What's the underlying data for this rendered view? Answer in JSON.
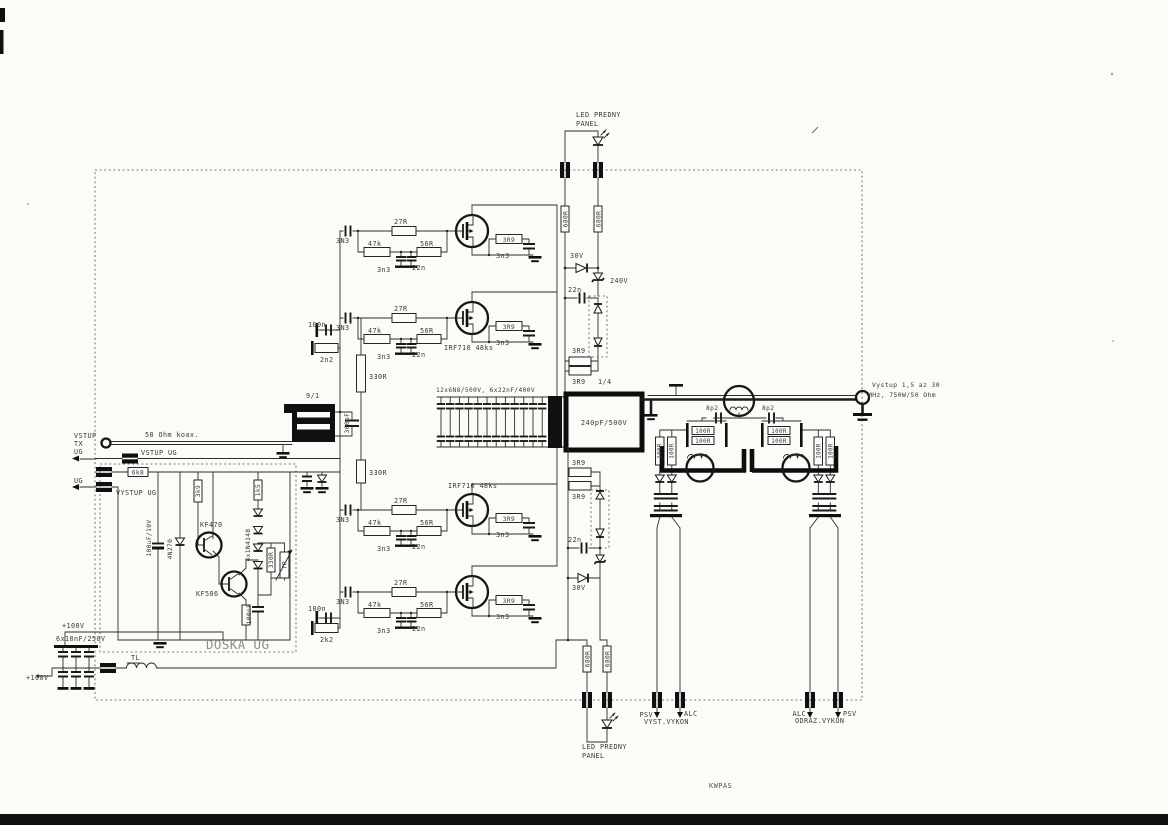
{
  "colors": {
    "ink": "#3a3a3a",
    "light": "#8e8e8e",
    "mid": "#555555",
    "bg": "#fbfbf8",
    "black": "#101010"
  },
  "labels": [
    {
      "n": "led-front-panel-top-1",
      "t": "LED PREDNY",
      "x": 576,
      "y": 117
    },
    {
      "n": "led-front-panel-top-2",
      "t": "PANEL",
      "x": 576,
      "y": 126
    },
    {
      "n": "res-680r-top-left",
      "t": "680R",
      "x": 567.3,
      "y": 219,
      "r": -90,
      "a": "m",
      "s": 6.2
    },
    {
      "n": "res-680r-top-right",
      "t": "680R",
      "x": 600.3,
      "y": 219,
      "r": -90,
      "a": "m",
      "s": 6.2
    },
    {
      "n": "diode-30v-top",
      "t": "30V",
      "x": 570,
      "y": 258
    },
    {
      "n": "zener-240v-top",
      "t": "240V",
      "x": 610,
      "y": 283
    },
    {
      "n": "cap-22n-top",
      "t": "22n",
      "x": 568,
      "y": 292
    },
    {
      "n": "res-3r9-top-upper",
      "t": "3R9",
      "x": 572,
      "y": 353
    },
    {
      "n": "res-3r9-top-lower",
      "t": "3R9",
      "x": 572,
      "y": 384
    },
    {
      "n": "res-3r9-top-fraction",
      "t": "1/4",
      "x": 598,
      "y": 384
    },
    {
      "n": "cap-3n3-input-1",
      "t": "3N3",
      "x": 336,
      "y": 243
    },
    {
      "n": "res-27r-1",
      "t": "27R",
      "x": 394,
      "y": 224
    },
    {
      "n": "res-47k-1",
      "t": "47k",
      "x": 368,
      "y": 246
    },
    {
      "n": "res-56r-1",
      "t": "56R",
      "x": 420,
      "y": 246
    },
    {
      "n": "cap-3n3-gnd-1",
      "t": "3n3",
      "x": 377,
      "y": 272
    },
    {
      "n": "cap-22n-gnd-1",
      "t": "22n",
      "x": 412,
      "y": 270
    },
    {
      "n": "res-3r9-fb-1",
      "t": "3R9",
      "x": 509,
      "y": 242,
      "a": "m",
      "s": 6.2
    },
    {
      "n": "cap-3n3-fb-1",
      "t": "3n3",
      "x": 496,
      "y": 258
    },
    {
      "n": "cap-100n-input-upper",
      "t": "100n",
      "x": 308,
      "y": 327
    },
    {
      "n": "res-2n2-input-upper",
      "t": "2n2",
      "x": 320,
      "y": 362
    },
    {
      "n": "cap-3n3-input-2",
      "t": "3N3",
      "x": 336,
      "y": 330
    },
    {
      "n": "res-27r-2",
      "t": "27R",
      "x": 394,
      "y": 311
    },
    {
      "n": "res-47k-2",
      "t": "47k",
      "x": 368,
      "y": 333
    },
    {
      "n": "res-56r-2",
      "t": "56R",
      "x": 420,
      "y": 333
    },
    {
      "n": "cap-3n3-gnd-2",
      "t": "3n3",
      "x": 377,
      "y": 359
    },
    {
      "n": "cap-22n-gnd-2",
      "t": "22n",
      "x": 412,
      "y": 357
    },
    {
      "n": "res-3r9-fb-2",
      "t": "3R9",
      "x": 509,
      "y": 329,
      "a": "m",
      "s": 6.2
    },
    {
      "n": "cap-3n3-fb-2",
      "t": "3n3",
      "x": 496,
      "y": 345
    },
    {
      "n": "mosfet-type-upper",
      "t": "IRF710 48ks",
      "x": 444,
      "y": 350
    },
    {
      "n": "mosfet-type-lower",
      "t": "IRF710 48ks",
      "x": 448,
      "y": 488
    },
    {
      "n": "cap-3n3-input-3",
      "t": "3N3",
      "x": 336,
      "y": 522
    },
    {
      "n": "res-27r-3",
      "t": "27R",
      "x": 394,
      "y": 503
    },
    {
      "n": "res-47k-3",
      "t": "47k",
      "x": 368,
      "y": 525
    },
    {
      "n": "res-56r-3",
      "t": "56R",
      "x": 420,
      "y": 525
    },
    {
      "n": "cap-3n3-gnd-3",
      "t": "3n3",
      "x": 377,
      "y": 551
    },
    {
      "n": "cap-22n-gnd-3",
      "t": "22n",
      "x": 412,
      "y": 549
    },
    {
      "n": "res-3r9-fb-3",
      "t": "3R9",
      "x": 509,
      "y": 521,
      "a": "m",
      "s": 6.2
    },
    {
      "n": "cap-3n3-fb-3",
      "t": "3n3",
      "x": 496,
      "y": 537
    },
    {
      "n": "cap-100n-input-lower",
      "t": "100n",
      "x": 308,
      "y": 611
    },
    {
      "n": "res-2k2-input-lower",
      "t": "2k2",
      "x": 320,
      "y": 642
    },
    {
      "n": "cap-3n3-input-4",
      "t": "3N3",
      "x": 336,
      "y": 604
    },
    {
      "n": "res-27r-4",
      "t": "27R",
      "x": 394,
      "y": 585
    },
    {
      "n": "res-47k-4",
      "t": "47k",
      "x": 368,
      "y": 607
    },
    {
      "n": "res-56r-4",
      "t": "56R",
      "x": 420,
      "y": 607
    },
    {
      "n": "cap-3n3-gnd-4",
      "t": "3n3",
      "x": 377,
      "y": 633
    },
    {
      "n": "cap-22n-gnd-4",
      "t": "22n",
      "x": 412,
      "y": 631
    },
    {
      "n": "res-3r9-fb-4",
      "t": "3R9",
      "x": 509,
      "y": 603,
      "a": "m",
      "s": 6.2
    },
    {
      "n": "cap-3n3-fb-4",
      "t": "3n3",
      "x": 496,
      "y": 619
    },
    {
      "n": "res-330r-upper",
      "t": "330R",
      "x": 369,
      "y": 379
    },
    {
      "n": "transformer-ratio",
      "t": "9/1",
      "x": 306,
      "y": 398
    },
    {
      "n": "cap-360pf",
      "t": "360pF",
      "x": 349,
      "y": 423,
      "r": -90,
      "a": "m",
      "s": 6.2
    },
    {
      "n": "res-330r-lower",
      "t": "330R",
      "x": 369,
      "y": 475
    },
    {
      "n": "input-vstup",
      "t": "VSTUP",
      "x": 74,
      "y": 438
    },
    {
      "n": "input-tx",
      "t": "TX",
      "x": 74,
      "y": 446
    },
    {
      "n": "coax-type",
      "t": "50 Ohm koax.",
      "x": 145,
      "y": 437
    },
    {
      "n": "ug-in-label",
      "t": "UG",
      "x": 74,
      "y": 454
    },
    {
      "n": "vstup-ug",
      "t": "VSTUP UG",
      "x": 141,
      "y": 455
    },
    {
      "n": "res-6k8",
      "t": "6k8",
      "x": 138,
      "y": 474.5,
      "a": "m",
      "s": 6.2
    },
    {
      "n": "ug-out-label",
      "t": "UG",
      "x": 74,
      "y": 483
    },
    {
      "n": "vystup-ug",
      "t": "VYSTUP UG",
      "x": 116,
      "y": 495
    },
    {
      "n": "cap-100uf",
      "t": "100uF/10V",
      "x": 151,
      "y": 538,
      "r": -90,
      "a": "m",
      "s": 6.2
    },
    {
      "n": "diode-4n270",
      "t": "4N270",
      "x": 172,
      "y": 549,
      "r": -90,
      "a": "m",
      "s": 6.2
    },
    {
      "n": "res-3k9",
      "t": "3k9",
      "x": 200,
      "y": 491,
      "r": -90,
      "a": "m",
      "s": 6.2
    },
    {
      "n": "res-1k5",
      "t": "1k5",
      "x": 260,
      "y": 490,
      "r": -90,
      "a": "m",
      "s": 6.2
    },
    {
      "n": "transistor-kf470",
      "t": "KF470",
      "x": 200,
      "y": 527
    },
    {
      "n": "diodes-4x1n4148",
      "t": "4x1N4148",
      "x": 250,
      "y": 545,
      "r": -90,
      "a": "m",
      "s": 6.2
    },
    {
      "n": "transistor-kf506",
      "t": "KF506",
      "x": 196,
      "y": 596
    },
    {
      "n": "res-330r-doska",
      "t": "330R",
      "x": 273,
      "y": 560,
      "r": -90,
      "a": "m",
      "s": 6.2
    },
    {
      "n": "trimmer-tr",
      "t": "TR",
      "x": 286.5,
      "y": 565,
      "r": -90,
      "a": "m",
      "s": 6.2
    },
    {
      "n": "cap-100nf",
      "t": "100nF",
      "x": 251,
      "y": 614,
      "r": -90,
      "a": "m",
      "s": 6.2
    },
    {
      "n": "board-name",
      "t": "DOSKA UG",
      "x": 206,
      "y": 649,
      "s": 12.5,
      "ls": 2,
      "c": "light"
    },
    {
      "n": "supply-100v-upper",
      "t": "+100V",
      "x": 62,
      "y": 628
    },
    {
      "n": "cap-bank-supply",
      "t": "6x10nF/250V",
      "x": 56,
      "y": 641
    },
    {
      "n": "supply-100v-lower",
      "t": "+100V",
      "x": 26,
      "y": 680
    },
    {
      "n": "inductor-tl",
      "t": "TL",
      "x": 131,
      "y": 660
    },
    {
      "n": "cap-bank-output",
      "t": "12x6N8/500V, 6x22nF/400V",
      "x": 436,
      "y": 392,
      "s": 6.2
    },
    {
      "n": "cap-240pf",
      "t": "240pF/500V",
      "x": 604,
      "y": 425,
      "a": "m",
      "s": 7
    },
    {
      "n": "res-3r9-bot-upper",
      "t": "3R9",
      "x": 572,
      "y": 465
    },
    {
      "n": "res-3r9-bot-lower",
      "t": "3R9",
      "x": 572,
      "y": 499
    },
    {
      "n": "cap-22n-bot",
      "t": "22n",
      "x": 568,
      "y": 542
    },
    {
      "n": "diode-30v-bot",
      "t": "30V",
      "x": 572,
      "y": 590
    },
    {
      "n": "res-680r-bot-left",
      "t": "680R",
      "x": 589.3,
      "y": 659,
      "r": -90,
      "a": "m",
      "s": 6.2
    },
    {
      "n": "res-680r-bot-right",
      "t": "680R",
      "x": 609.3,
      "y": 659,
      "r": -90,
      "a": "m",
      "s": 6.2
    },
    {
      "n": "led-front-panel-bot-1",
      "t": "LED PREDNY",
      "x": 582,
      "y": 749
    },
    {
      "n": "led-front-panel-bot-2",
      "t": "PANEL",
      "x": 582,
      "y": 758
    },
    {
      "n": "meter-psv-fwd",
      "t": "PSV",
      "x": 653,
      "y": 717,
      "a": "e"
    },
    {
      "n": "meter-alc-fwd",
      "t": "ALC",
      "x": 684,
      "y": 716
    },
    {
      "n": "meter-fwd-caption",
      "t": "VYST.VYKON",
      "x": 644,
      "y": 724
    },
    {
      "n": "meter-alc-ref",
      "t": "ALC",
      "x": 806,
      "y": 716,
      "a": "e"
    },
    {
      "n": "meter-psv-ref",
      "t": "PSV",
      "x": 843,
      "y": 716
    },
    {
      "n": "meter-ref-caption",
      "t": "ODRAZ.VYKON",
      "x": 795,
      "y": 723
    },
    {
      "n": "cap-8p2-left",
      "t": "8p2",
      "x": 706,
      "y": 410,
      "s": 6.2
    },
    {
      "n": "cap-8p2-right",
      "t": "8p2",
      "x": 762,
      "y": 410,
      "s": 6.2
    },
    {
      "n": "res-100r-left-a",
      "t": "100R",
      "x": 703,
      "y": 433,
      "a": "m",
      "s": 5.8
    },
    {
      "n": "res-100r-left-b",
      "t": "100R",
      "x": 703,
      "y": 443,
      "a": "m",
      "s": 5.8
    },
    {
      "n": "res-100r-right-a",
      "t": "100R",
      "x": 779,
      "y": 433,
      "a": "m",
      "s": 5.8
    },
    {
      "n": "res-100r-right-b",
      "t": "100R",
      "x": 779,
      "y": 443,
      "a": "m",
      "s": 5.8
    },
    {
      "n": "res-100r-vert-1",
      "t": "100R",
      "x": 661.5,
      "y": 451,
      "r": -90,
      "a": "m",
      "s": 5.8
    },
    {
      "n": "res-100r-vert-2",
      "t": "100R",
      "x": 673.5,
      "y": 451,
      "r": -90,
      "a": "m",
      "s": 5.8
    },
    {
      "n": "res-100r-vert-3",
      "t": "100R",
      "x": 820.3,
      "y": 451,
      "r": -90,
      "a": "m",
      "s": 5.8
    },
    {
      "n": "res-100r-vert-4",
      "t": "100R",
      "x": 832.3,
      "y": 451,
      "r": -90,
      "a": "m",
      "s": 5.8
    },
    {
      "n": "output-spec-1",
      "t": "Vystup 1,5 az 30",
      "x": 872,
      "y": 387,
      "s": 6.4
    },
    {
      "n": "output-spec-2",
      "t": "MHz, 750W/50 Ohm",
      "x": 868,
      "y": 397,
      "s": 6.4
    },
    {
      "n": "project-name",
      "t": "KWPAS",
      "x": 709,
      "y": 788,
      "s": 7,
      "ls": 2.5,
      "c": "mid"
    }
  ]
}
